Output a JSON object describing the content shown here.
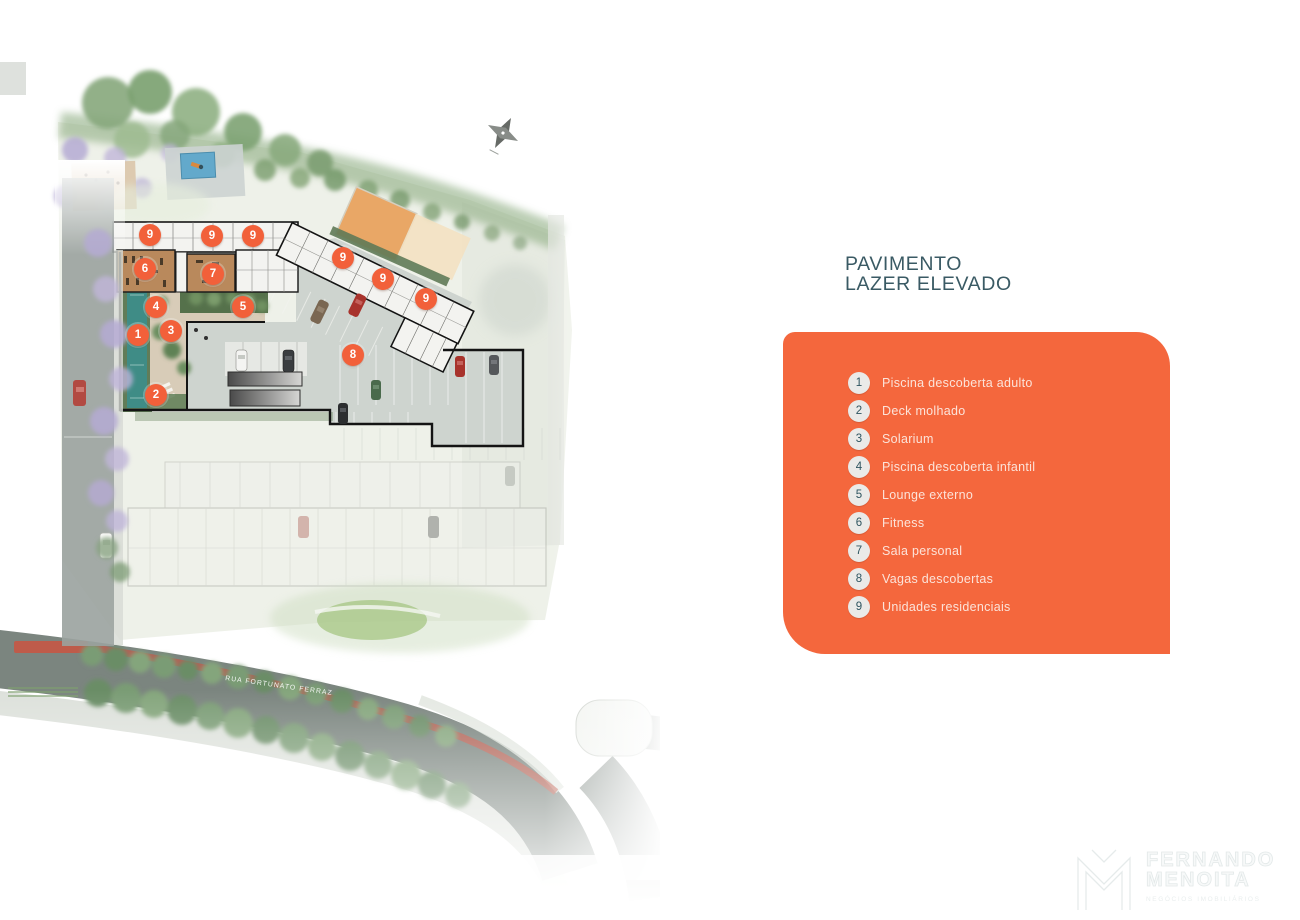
{
  "title": {
    "line1": "PAVIMENTO",
    "line2": "LAZER ELEVADO"
  },
  "colors": {
    "accent_orange": "#f4673d",
    "marker_orange": "#f2603a",
    "badge_bg": "#eaeae8",
    "badge_num": "#2f5560",
    "title_text": "#3a5a64",
    "legend_text": "#fdeee7"
  },
  "legend": {
    "items": [
      {
        "num": "1",
        "label": "Piscina descoberta adulto"
      },
      {
        "num": "2",
        "label": "Deck molhado"
      },
      {
        "num": "3",
        "label": "Solarium"
      },
      {
        "num": "4",
        "label": "Piscina descoberta infantil"
      },
      {
        "num": "5",
        "label": "Lounge externo"
      },
      {
        "num": "6",
        "label": "Fitness"
      },
      {
        "num": "7",
        "label": "Sala personal"
      },
      {
        "num": "8",
        "label": "Vagas descobertas"
      },
      {
        "num": "9",
        "label": "Unidades residenciais"
      }
    ]
  },
  "map": {
    "street_label": "RUA FORTUNATO FERRAZ",
    "compass_icon": "north-arrow",
    "markers": [
      {
        "num": "9",
        "x": 150,
        "y": 235
      },
      {
        "num": "9",
        "x": 212,
        "y": 236
      },
      {
        "num": "9",
        "x": 253,
        "y": 236
      },
      {
        "num": "9",
        "x": 343,
        "y": 258
      },
      {
        "num": "9",
        "x": 383,
        "y": 279
      },
      {
        "num": "9",
        "x": 426,
        "y": 299
      },
      {
        "num": "6",
        "x": 145,
        "y": 269
      },
      {
        "num": "7",
        "x": 213,
        "y": 274
      },
      {
        "num": "4",
        "x": 156,
        "y": 307
      },
      {
        "num": "5",
        "x": 243,
        "y": 307
      },
      {
        "num": "1",
        "x": 138,
        "y": 335
      },
      {
        "num": "3",
        "x": 171,
        "y": 331
      },
      {
        "num": "2",
        "x": 156,
        "y": 395
      },
      {
        "num": "8",
        "x": 353,
        "y": 355
      }
    ]
  },
  "watermark": {
    "name_line1": "FERNANDO",
    "name_line2": "MENOITA",
    "tagline": "NEGÓCIOS IMOBILIÁRIOS"
  }
}
